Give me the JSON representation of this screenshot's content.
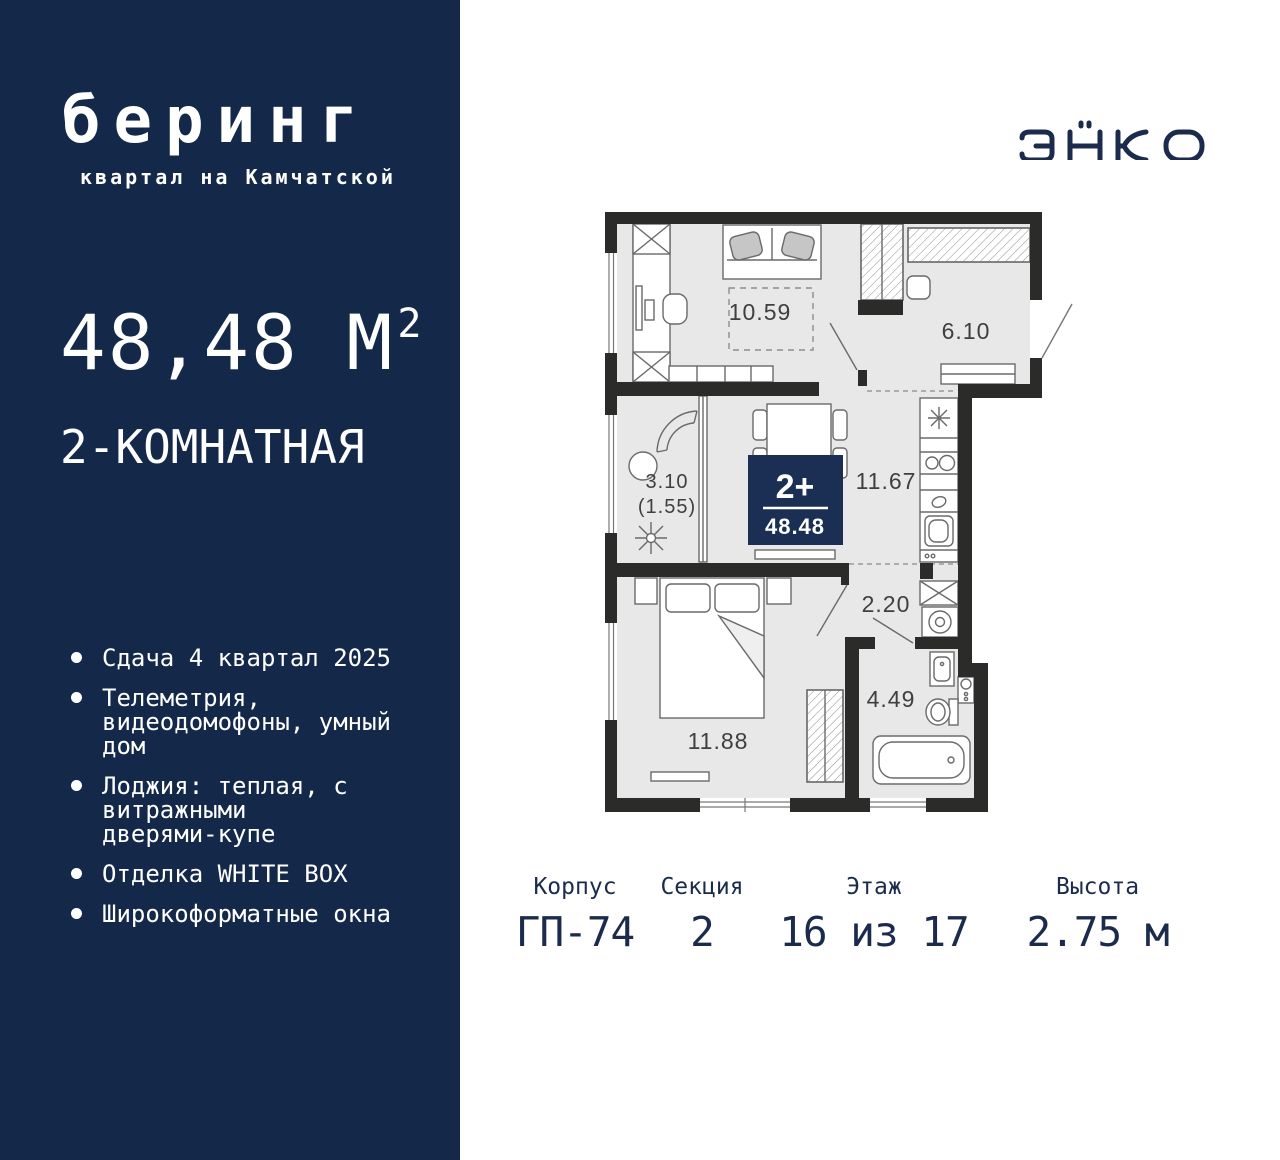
{
  "brand": {
    "name": "беринг",
    "tagline": "квартал на Камчатской",
    "developer": "ЭНКО"
  },
  "apartment": {
    "area_value": "48,48",
    "area_unit": "М",
    "area_sup": "2",
    "type_label": "2-КОМНАТНАЯ"
  },
  "features": [
    {
      "lines": [
        "Сдача 4 квартал 2025"
      ]
    },
    {
      "lines": [
        "Телеметрия,",
        "видеодомофоны, умный",
        "дом"
      ]
    },
    {
      "lines": [
        "Лоджия: теплая, с",
        "витражными",
        "дверями-купе"
      ]
    },
    {
      "lines": [
        "Отделка WHITE BOX"
      ]
    },
    {
      "lines": [
        "Широкоформатные окна"
      ]
    }
  ],
  "plan": {
    "badge": {
      "rooms": "2+",
      "area": "48.48"
    },
    "rooms": {
      "living": "10.59",
      "hallway": "6.10",
      "loggia": "3.10",
      "loggia_reduced": "(1.55)",
      "kitchen": "11.67",
      "corridor": "2.20",
      "bathroom": "4.49",
      "bedroom": "11.88"
    }
  },
  "info": {
    "items": [
      {
        "label": "Корпус",
        "value": "ГП-74"
      },
      {
        "label": "Секция",
        "value": "2"
      },
      {
        "label": "Этаж",
        "value": "16 из 17"
      },
      {
        "label": "Высота",
        "value": "2.75 м"
      }
    ]
  },
  "colors": {
    "navy": "#14294A",
    "badge_navy": "#1B2F55",
    "wall": "#2B2B29",
    "room_fill": "#E8E8E8",
    "text_navy": "#1B2B4D"
  }
}
